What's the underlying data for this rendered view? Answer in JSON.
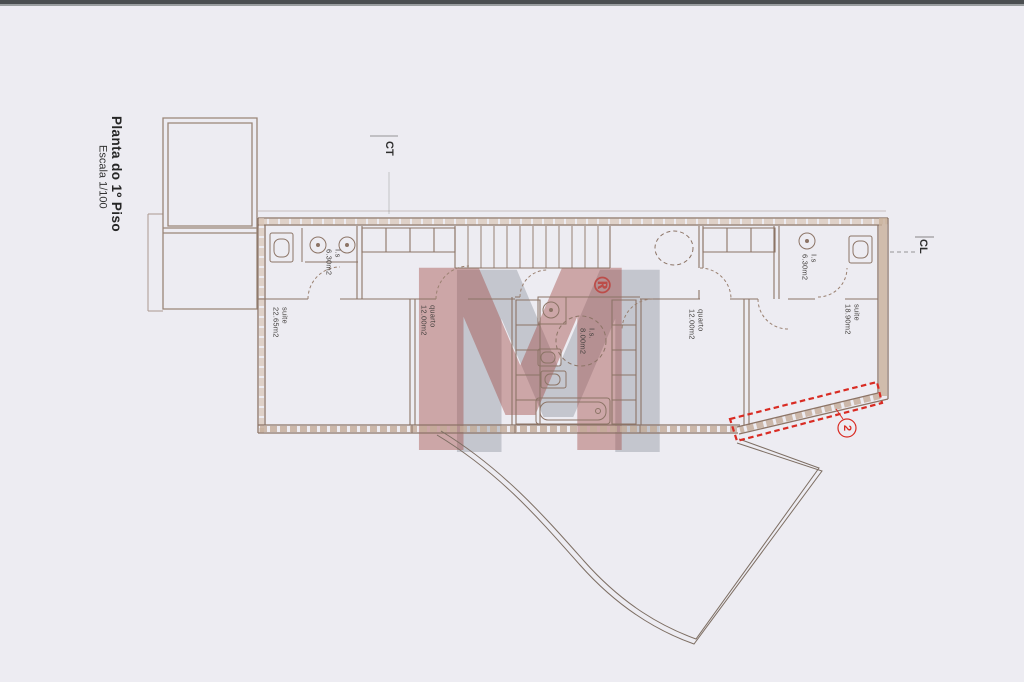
{
  "document": {
    "title": "Planta do 1º Piso",
    "scale": "Escala 1/100"
  },
  "plan_labels": {
    "ct": "CT",
    "cl": "CL"
  },
  "rooms": [
    {
      "name": "I.s",
      "area": "6.30m2"
    },
    {
      "name": "suite",
      "area": "22.65m2"
    },
    {
      "name": "quarto",
      "area": "12.00m2"
    },
    {
      "name": "I.s.",
      "area": "8.00m2"
    },
    {
      "name": "quarto",
      "area": "12.00m2"
    },
    {
      "name": "I.s",
      "area": "6.30m2"
    },
    {
      "name": "suite",
      "area": "18.90m2"
    }
  ],
  "callout": {
    "number": "2"
  },
  "watermark": {
    "letter": "M",
    "registered_mark": "®"
  },
  "colors": {
    "paper": "#edecf2",
    "plan_line": "#8c7466",
    "wall_fill": "#c9b39f",
    "accent_red": "#d92b23",
    "watermark_red": "#a0463f",
    "watermark_gray": "#808894",
    "label_text": "#44403e"
  }
}
